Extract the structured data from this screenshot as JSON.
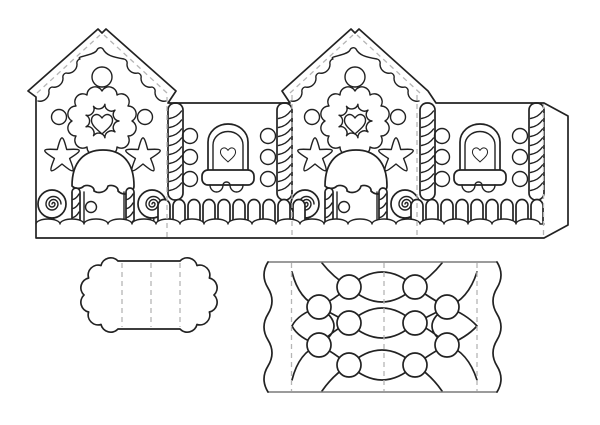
{
  "document": {
    "title": "Gingerbread house papercraft template",
    "description": "Black and white printable cut-out sheet: a strip of two gingerbread house fronts and two side walls, a scalloped base panel, and a quilted roof panel with gumdrops."
  },
  "colors": {
    "outline": "#222222",
    "detail": "#222222",
    "fold_line": "#b5b5b5",
    "edge_line": "#7a7a7a",
    "paper": "#ffffff"
  },
  "pieces": {
    "walls_strip": {
      "name": "Walls strip",
      "panel_order": [
        "house-front",
        "side-wall",
        "house-front",
        "side-wall",
        "glue-tab"
      ],
      "fold_line_count": 4,
      "roof_fold_lines_per_house": 2,
      "house_front_decorations": [
        "icing roof drips",
        "round ornament",
        "scalloped wreath with heart",
        "candy dots",
        "star cookies",
        "iced doorway",
        "doorknob",
        "candy cane door posts",
        "lollipops"
      ],
      "side_wall_decorations": [
        "candy cane pillars",
        "gumdrop buttons",
        "arched window with heart",
        "iced window box",
        "picket fence",
        "snow drift ground"
      ]
    },
    "base_panel": {
      "name": "Scalloped base panel",
      "fold_line_count": 3,
      "edge_style": "scalloped ends"
    },
    "roof_panel": {
      "name": "Quilted roof panel",
      "fold_line_count": 3,
      "pattern": "ogee quilt lattice with gumdrops",
      "gumdrop_count": 10,
      "edge_style": "wavy icing sides"
    }
  },
  "counts": {
    "houses": 2,
    "side_walls": 2,
    "windows": 2,
    "doors": 2,
    "lollipops": 4,
    "star_cookies": 4,
    "wreaths": 2,
    "ornaments": 2,
    "buttons_per_wall": 6,
    "fence_pickets": 19,
    "glue_tabs": 1
  }
}
